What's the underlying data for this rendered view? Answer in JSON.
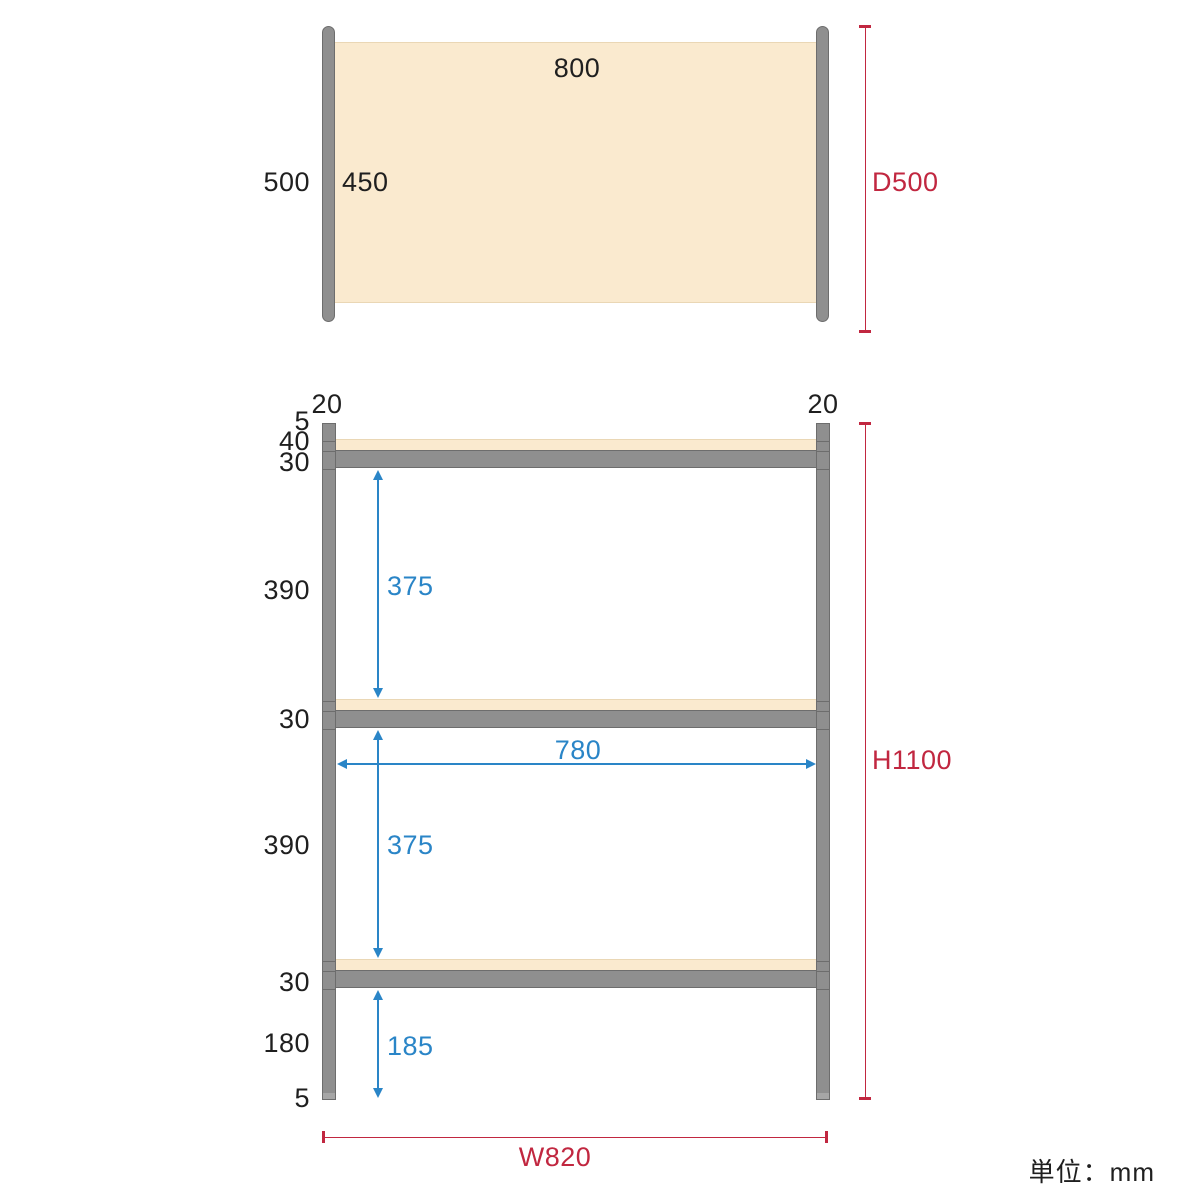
{
  "unit_note": "単位：mm",
  "colors": {
    "accent_red": "#c12740",
    "accent_blue": "#2a85c7",
    "frame_gray": "#8f8f8f",
    "board_beige": "#faeacf"
  },
  "top_view": {
    "board_width": "800",
    "outer_depth": "500",
    "inner_depth": "450",
    "depth_dim": "D500"
  },
  "front_view": {
    "post_width_left": "20",
    "post_width_right": "20",
    "side_labels": [
      "5",
      "40",
      "30",
      "390",
      "30",
      "390",
      "30",
      "180",
      "5"
    ],
    "clearance_top": "375",
    "clearance_middle": "375",
    "clearance_bottom": "185",
    "inner_width": "780",
    "height_dim": "H1100",
    "width_dim": "W820"
  }
}
